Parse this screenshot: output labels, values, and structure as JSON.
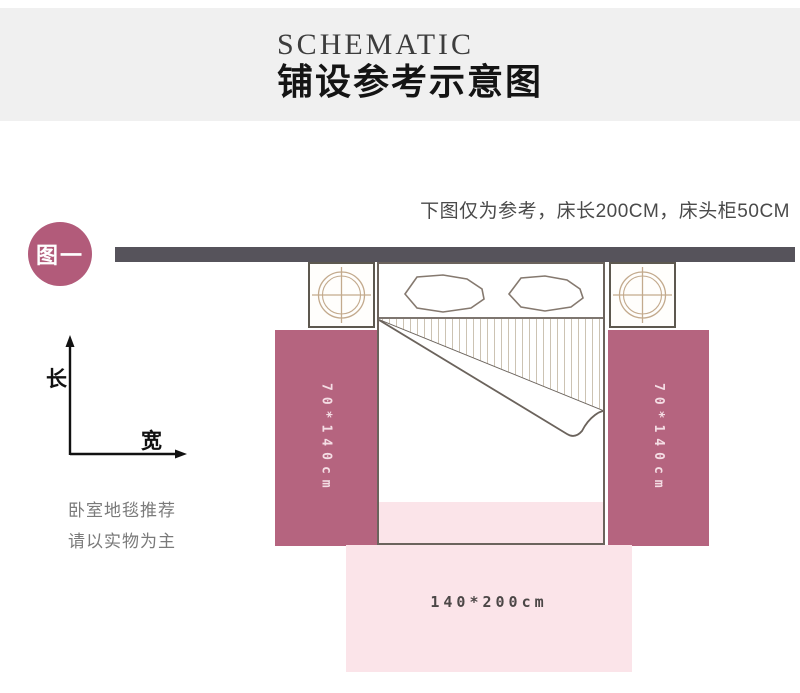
{
  "header": {
    "title_en": "SCHEMATIC",
    "title_zh": "铺设参考示意图"
  },
  "note": "下图仅为参考，床长200CM，床头柜50CM",
  "badge": {
    "label": "图一"
  },
  "axis": {
    "vertical_label": "长",
    "horizontal_label": "宽"
  },
  "carpets": {
    "left_label": "70*140cm",
    "right_label": "70*140cm",
    "bottom_label": "140*200cm"
  },
  "footnote": {
    "line1": "卧室地毯推荐",
    "line2": "请以实物为主"
  },
  "colors": {
    "header_bg": "#f0f0f0",
    "wall": "#56535b",
    "carpet_mauve": "#b5647f",
    "badge_mauve": "#b25b7a",
    "carpet_pink": "#fbe4e9",
    "line_brown": "#6b635c",
    "hatch_tan": "#ccc3b3",
    "nightstand_tan": "#c3aa8d"
  }
}
